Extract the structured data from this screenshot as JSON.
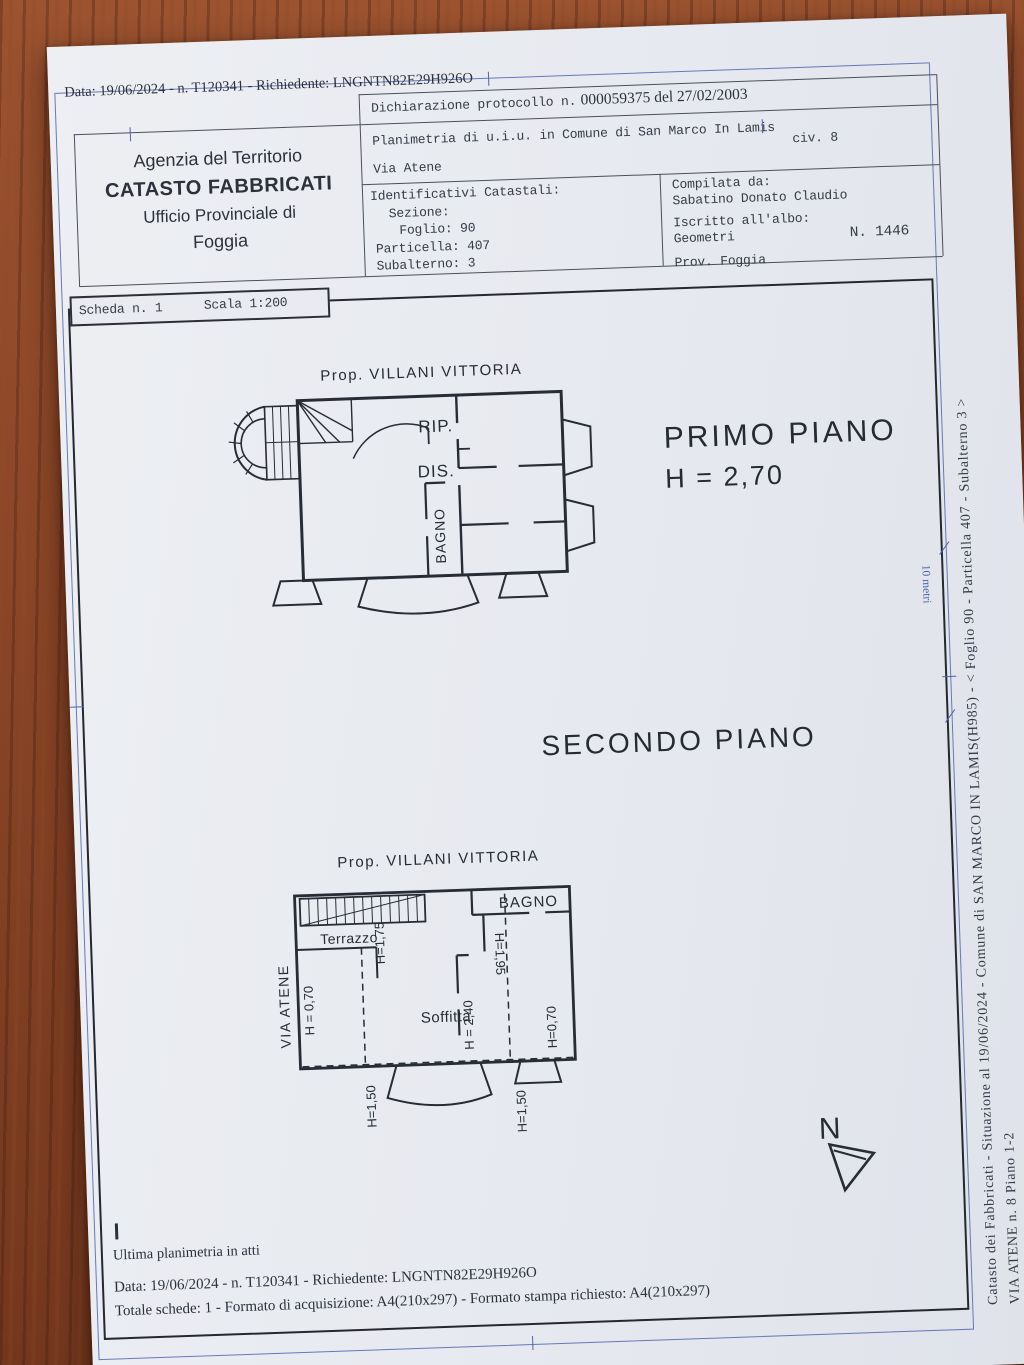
{
  "colors": {
    "wood": "#84442a",
    "paper": "#e8eaef",
    "ink": "#353c47",
    "frame_blue": "#4e66ac",
    "frame_dark": "#24282f"
  },
  "top_meta": "Data: 19/06/2024 - n. T120341 - Richiedente: LNGNTN82E29H926O",
  "header": {
    "office": {
      "line1": "Agenzia del Territorio",
      "line2": "CATASTO FABBRICATI",
      "line3": "Ufficio Provinciale di",
      "line4": "Foggia"
    },
    "declaration_prefix": "Dichiarazione protocollo n.",
    "declaration_number": "000059375 del 27/02/2003",
    "planimetria": "Planimetria di u.i.u. in Comune di San Marco In Lamis",
    "civ": "civ. 8",
    "street": "Via Atene",
    "identificativi": {
      "title": "Identificativi Catastali:",
      "sezione": "Sezione:",
      "foglio": "Foglio: 90",
      "particella": "Particella: 407",
      "subalterno": "Subalterno: 3"
    },
    "compilata": {
      "title": "Compilata da:",
      "name": "Sabatino Donato Claudio",
      "albo_label": "Iscritto all'albo:",
      "albo_value": "Geometri",
      "prov": "Prov. Foggia",
      "number": "N.  1446"
    }
  },
  "scheda": {
    "label": "Scheda n. 1",
    "scala": "Scala 1:200"
  },
  "plan1": {
    "owner": "Prop. VILLANI VITTORIA",
    "room_rip": "RIP.",
    "room_dis": "DIS.",
    "room_bagno": "BAGNO",
    "title": "PRIMO PIANO",
    "height": "H = 2,70"
  },
  "plan2_title": "SECONDO PIANO",
  "plan2": {
    "owner": "Prop. VILLANI VITTORIA",
    "room_bagno": "BAGNO",
    "room_terrazzo": "Terrazzo",
    "room_soffitta": "Soffitta",
    "street_label": "VIA ATENE",
    "h175": "H=1,75",
    "h195": "H=1,95",
    "h070_left": "H = 0,70",
    "h240": "H = 2,40",
    "h070_right": "H=0,70",
    "h150_left": "H=1,50",
    "h150_right": "H=1,50"
  },
  "north_label": "N",
  "scale_bar_label": "10 metri",
  "footer": {
    "line1": "Ultima planimetria in atti",
    "line2": "Data: 19/06/2024 - n. T120341 - Richiedente: LNGNTN82E29H926O",
    "line3": "Totale schede: 1 - Formato di acquisizione: A4(210x297)  - Formato stampa richiesto: A4(210x297)"
  },
  "side_text": {
    "line1": "Catasto dei Fabbricati - Situazione al 19/06/2024 - Comune di SAN MARCO IN LAMIS(H985) - <  Foglio 90 - Particella  407 - Subalterno 3 >",
    "line2": "VIA ATENE n. 8 Piano 1-2"
  }
}
